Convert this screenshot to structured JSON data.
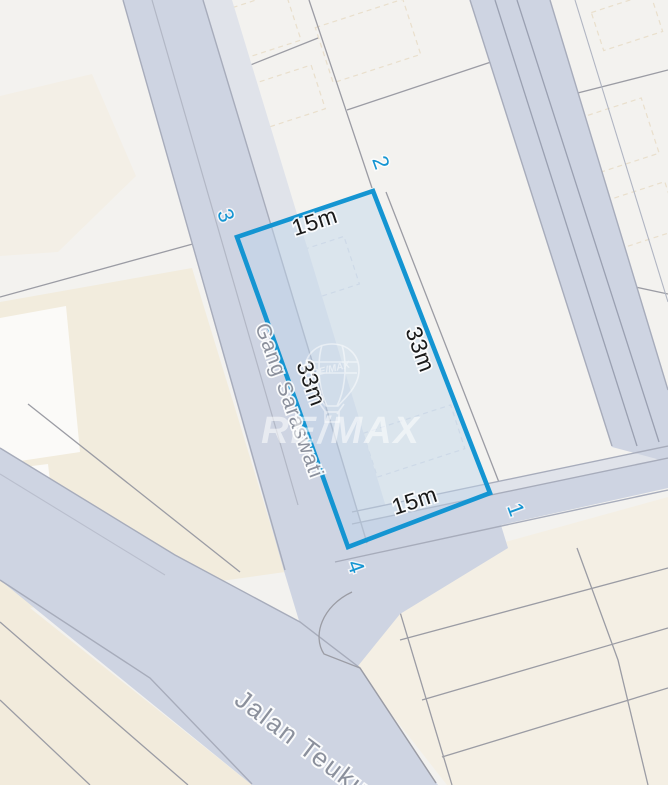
{
  "map": {
    "type": "cadastral-parcel-map",
    "plot": {
      "dimension_labels": {
        "top": "15m",
        "right": "33m",
        "left": "33m",
        "bottom": "15m"
      },
      "corner_labels": {
        "c1": "1",
        "c2": "2",
        "c3": "3",
        "c4": "4"
      }
    },
    "streets": {
      "gang": "Gang Saraswati",
      "jalan": "Jalan Teuku"
    },
    "watermark": {
      "brand": "RE/MAX",
      "balloon_label": "RE/MAX"
    },
    "colors": {
      "background": "#f3f2ef",
      "block_beige": "#f2ecdd",
      "road_fill": "#ced4e2",
      "road_edge": "#a7acbb",
      "parcel_line": "#9b9ca4",
      "plot_outline": "#1495d2",
      "plot_fill": "rgba(190,212,235,0.45)",
      "dimension_text": "#1a1a1a",
      "street_text": "#8b909c"
    }
  }
}
